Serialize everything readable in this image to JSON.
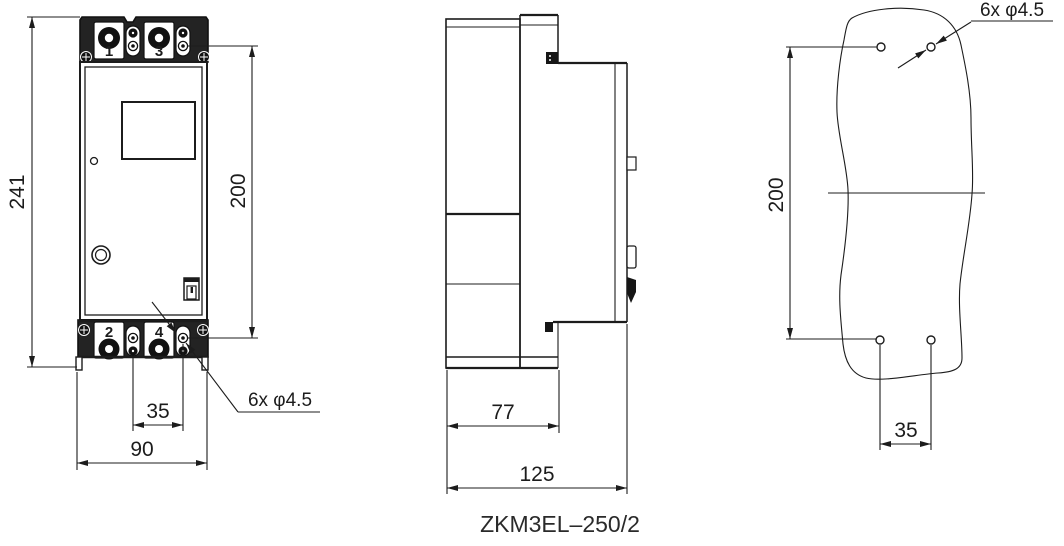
{
  "meta": {
    "background_color": "#ffffff",
    "line_color": "#1c1c1c",
    "cover_fill_color": "#232323"
  },
  "title": {
    "model": "ZKM3EL–250/2"
  },
  "front_view": {
    "terminals": {
      "top_left": "1",
      "top_right": "3",
      "bottom_left": "2",
      "bottom_right": "4"
    },
    "dims": {
      "overall_height": "241",
      "mounting_height": "200",
      "mounting_width": "35",
      "overall_width": "90",
      "hole_callout": "6x φ4.5"
    }
  },
  "side_view": {
    "dims": {
      "body_depth": "77",
      "overall_depth": "125"
    }
  },
  "mounting_view": {
    "dims": {
      "mounting_height": "200",
      "mounting_width": "35",
      "hole_callout": "6x φ4.5"
    }
  }
}
